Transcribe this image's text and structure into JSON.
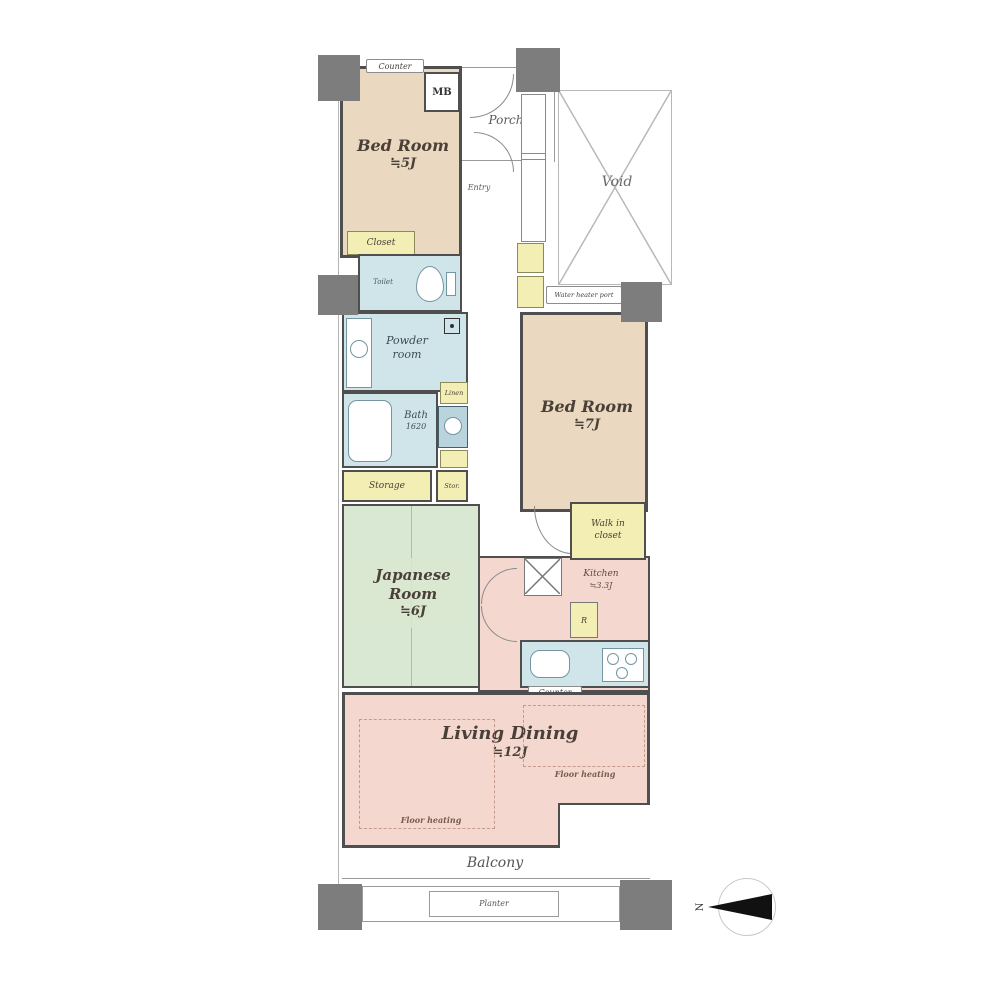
{
  "rooms": {
    "bedroom5": {
      "name": "Bed Room",
      "size": "≒5J"
    },
    "bedroom7": {
      "name": "Bed Room",
      "size": "≒7J"
    },
    "japanese": {
      "line1": "Japanese",
      "line2": "Room",
      "size": "≒6J"
    },
    "living": {
      "name": "Living Dining",
      "size": "≒12J"
    },
    "kitchen": {
      "name": "Kitchen",
      "size": "≒3.3J"
    },
    "powder": {
      "line1": "Powder",
      "line2": "room"
    },
    "bath": {
      "name": "Bath",
      "size": "1620"
    },
    "toilet": {
      "name": "Toilet"
    },
    "entry": {
      "name": "Entry"
    },
    "porch": {
      "name": "Porch"
    },
    "void": {
      "name": "Void"
    },
    "balcony": {
      "name": "Balcony"
    }
  },
  "storage": {
    "closet": "Closet",
    "walk_in_1": "Walk in",
    "walk_in_2": "closet",
    "storage_main": "Storage",
    "storage_small": "Stor.",
    "linen": "Linen",
    "ref": "R",
    "mb": "MB"
  },
  "annotations": {
    "counter_top": "Counter",
    "counter_kitchen": "Counter",
    "floor_heating": "Floor heating",
    "water_heater": "Water heater port",
    "planter": "Planter",
    "north": "N"
  },
  "colors": {
    "bedroom_beige": "#ead9c0",
    "japanese_green": "#d9e8d2",
    "living_pink": "#f4d8cf",
    "wet_cyan": "#cfe5e9",
    "storage_yellow": "#f2eeb4",
    "pillar_gray": "#7d7d7d",
    "wall_gray": "#4f4f4f"
  }
}
